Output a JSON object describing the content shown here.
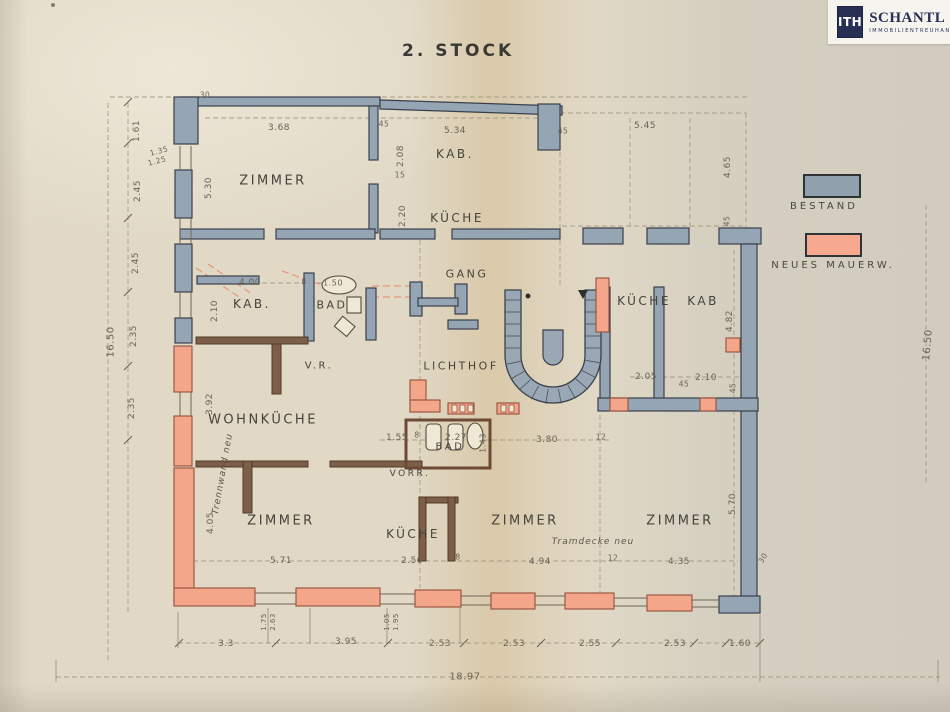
{
  "title": "2. STOCK",
  "logo": {
    "mark": "ITH",
    "name": "SCHANTL",
    "subtitle": "IMMOBILIENTREUHAND"
  },
  "legend": {
    "items": [
      {
        "label": "BESTAND",
        "color": "#91a0ad"
      },
      {
        "label": "NEUES MAUERW.",
        "color": "#f6a98e"
      }
    ]
  },
  "colors": {
    "paper": "#e1d9c6",
    "existing_wall": "#96a5b3",
    "new_wall": "#f4a68a",
    "partition": "#7d5f49",
    "ink": "#45433c"
  },
  "plan": {
    "labels": [
      {
        "text": "ZIMMER",
        "x": 273,
        "y": 181,
        "cls": "room"
      },
      {
        "text": "KAB.",
        "x": 455,
        "y": 154,
        "cls": "room",
        "size": 12
      },
      {
        "text": "KÜCHE",
        "x": 457,
        "y": 218,
        "cls": "room",
        "size": 12
      },
      {
        "text": "GANG",
        "x": 467,
        "y": 274,
        "cls": "room",
        "size": 11
      },
      {
        "text": "KAB.",
        "x": 252,
        "y": 304,
        "cls": "room",
        "size": 12
      },
      {
        "text": "BAD",
        "x": 332,
        "y": 305,
        "cls": "room",
        "size": 11
      },
      {
        "text": "KÜCHE",
        "x": 644,
        "y": 301,
        "cls": "room",
        "size": 12
      },
      {
        "text": "KAB",
        "x": 703,
        "y": 301,
        "cls": "room",
        "size": 12
      },
      {
        "text": "V.R.",
        "x": 319,
        "y": 366,
        "cls": "room",
        "size": 10
      },
      {
        "text": "LICHTHOF",
        "x": 461,
        "y": 366,
        "cls": "room",
        "size": 11
      },
      {
        "text": "WOHNKÜCHE",
        "x": 263,
        "y": 420,
        "cls": "room"
      },
      {
        "text": "BAD",
        "x": 450,
        "y": 447,
        "cls": "room",
        "size": 10
      },
      {
        "text": "VORR.",
        "x": 410,
        "y": 474,
        "cls": "room",
        "size": 9
      },
      {
        "text": "KÜCHE",
        "x": 413,
        "y": 534,
        "cls": "room",
        "size": 12
      },
      {
        "text": "ZIMMER",
        "x": 281,
        "y": 521,
        "cls": "room"
      },
      {
        "text": "ZIMMER",
        "x": 525,
        "y": 521,
        "cls": "room"
      },
      {
        "text": "ZIMMER",
        "x": 680,
        "y": 521,
        "cls": "room"
      },
      {
        "text": "Tramdecke neu",
        "x": 593,
        "y": 542,
        "cls": "note"
      },
      {
        "text": "Trennwand neu",
        "x": 223,
        "y": 474,
        "cls": "note",
        "rot": -80
      },
      {
        "text": "30",
        "x": 205,
        "y": 95,
        "cls": "dim",
        "size": 7.5
      },
      {
        "text": "3.68",
        "x": 279,
        "y": 128,
        "cls": "dim"
      },
      {
        "text": "45",
        "x": 384,
        "y": 124,
        "cls": "dim",
        "size": 7.5
      },
      {
        "text": "5.34",
        "x": 455,
        "y": 131,
        "cls": "dim"
      },
      {
        "text": "45",
        "x": 563,
        "y": 131,
        "cls": "dim",
        "size": 7.5
      },
      {
        "text": "5.45",
        "x": 645,
        "y": 126,
        "cls": "dim"
      },
      {
        "text": "1.61",
        "x": 137,
        "y": 131,
        "cls": "dim",
        "rot": -90
      },
      {
        "text": "1.35",
        "x": 159,
        "y": 151,
        "cls": "dim",
        "size": 7.5,
        "rot": -15
      },
      {
        "text": "1.25",
        "x": 157,
        "y": 161,
        "cls": "dim",
        "size": 7.5,
        "rot": -15
      },
      {
        "text": "2.45",
        "x": 138,
        "y": 191,
        "cls": "dim",
        "rot": -90
      },
      {
        "text": "2.45",
        "x": 136,
        "y": 263,
        "cls": "dim",
        "rot": -90
      },
      {
        "text": "2.35",
        "x": 134,
        "y": 336,
        "cls": "dim",
        "rot": -90
      },
      {
        "text": "2.35",
        "x": 132,
        "y": 408,
        "cls": "dim",
        "rot": -90
      },
      {
        "text": "16.50",
        "x": 111,
        "y": 342,
        "cls": "dim",
        "rot": -90,
        "size": 10
      },
      {
        "text": "4.65",
        "x": 728,
        "y": 167,
        "cls": "dim",
        "rot": -90
      },
      {
        "text": "45",
        "x": 727,
        "y": 221,
        "cls": "dim",
        "rot": -90,
        "size": 7.5
      },
      {
        "text": "4.82",
        "x": 730,
        "y": 321,
        "cls": "dim",
        "rot": -90
      },
      {
        "text": "45",
        "x": 733,
        "y": 388,
        "cls": "dim",
        "rot": -90,
        "size": 7.5
      },
      {
        "text": "5.70",
        "x": 733,
        "y": 504,
        "cls": "dim",
        "rot": -90
      },
      {
        "text": "30",
        "x": 763,
        "y": 558,
        "cls": "dim",
        "rot": -60,
        "size": 7.5
      },
      {
        "text": "16.50",
        "x": 928,
        "y": 345,
        "cls": "dim",
        "rot": -85,
        "size": 10
      },
      {
        "text": "5.30",
        "x": 209,
        "y": 188,
        "cls": "dim",
        "rot": -90
      },
      {
        "text": "2.08",
        "x": 401,
        "y": 156,
        "cls": "dim",
        "rot": -90
      },
      {
        "text": "15",
        "x": 400,
        "y": 175,
        "cls": "dim",
        "size": 7.5
      },
      {
        "text": "2.20",
        "x": 403,
        "y": 216,
        "cls": "dim",
        "rot": -90
      },
      {
        "text": "4.00",
        "x": 250,
        "y": 283,
        "cls": "dim"
      },
      {
        "text": "8",
        "x": 304,
        "y": 282,
        "cls": "dim",
        "size": 7.5
      },
      {
        "text": "1.50",
        "x": 333,
        "y": 283,
        "cls": "dim",
        "size": 8
      },
      {
        "text": "2.10",
        "x": 215,
        "y": 311,
        "cls": "dim",
        "rot": -90
      },
      {
        "text": "3.92",
        "x": 210,
        "y": 404,
        "cls": "dim",
        "rot": -90
      },
      {
        "text": "4.05",
        "x": 211,
        "y": 523,
        "cls": "dim",
        "rot": -90
      },
      {
        "text": "1.55",
        "x": 397,
        "y": 438,
        "cls": "dim"
      },
      {
        "text": "8",
        "x": 417,
        "y": 435,
        "cls": "dim",
        "size": 7.5
      },
      {
        "text": "2.27",
        "x": 456,
        "y": 438,
        "cls": "dim"
      },
      {
        "text": "1.43",
        "x": 483,
        "y": 443,
        "cls": "dim",
        "rot": -90,
        "size": 8
      },
      {
        "text": "3.80",
        "x": 547,
        "y": 440,
        "cls": "dim"
      },
      {
        "text": "12",
        "x": 601,
        "y": 437,
        "cls": "dim",
        "size": 7.5
      },
      {
        "text": "2.05",
        "x": 646,
        "y": 377,
        "cls": "dim"
      },
      {
        "text": "45",
        "x": 684,
        "y": 384,
        "cls": "dim",
        "size": 7.5
      },
      {
        "text": "2.10",
        "x": 706,
        "y": 378,
        "cls": "dim"
      },
      {
        "text": "2.56",
        "x": 412,
        "y": 561,
        "cls": "dim"
      },
      {
        "text": "8",
        "x": 458,
        "y": 557,
        "cls": "dim",
        "size": 7.5
      },
      {
        "text": "4.94",
        "x": 540,
        "y": 562,
        "cls": "dim"
      },
      {
        "text": "12",
        "x": 613,
        "y": 558,
        "cls": "dim",
        "size": 7.5
      },
      {
        "text": "4.35",
        "x": 679,
        "y": 562,
        "cls": "dim"
      },
      {
        "text": "5.71",
        "x": 281,
        "y": 561,
        "cls": "dim"
      },
      {
        "text": "3.3",
        "x": 226,
        "y": 644,
        "cls": "dim"
      },
      {
        "text": "3.95",
        "x": 346,
        "y": 642,
        "cls": "dim"
      },
      {
        "text": "2.53",
        "x": 440,
        "y": 644,
        "cls": "dim"
      },
      {
        "text": "2.53",
        "x": 514,
        "y": 644,
        "cls": "dim"
      },
      {
        "text": "2.55",
        "x": 590,
        "y": 644,
        "cls": "dim"
      },
      {
        "text": "2.53",
        "x": 675,
        "y": 644,
        "cls": "dim"
      },
      {
        "text": "1.60",
        "x": 740,
        "y": 644,
        "cls": "dim"
      },
      {
        "text": "18.97",
        "x": 465,
        "y": 677,
        "cls": "dim",
        "size": 10
      },
      {
        "text": "1.75",
        "x": 264,
        "y": 622,
        "cls": "dim",
        "rot": -90,
        "size": 7
      },
      {
        "text": "2.63",
        "x": 273,
        "y": 622,
        "cls": "dim",
        "rot": -90,
        "size": 7
      },
      {
        "text": "1.05",
        "x": 387,
        "y": 622,
        "cls": "dim",
        "rot": -90,
        "size": 7
      },
      {
        "text": "1.95",
        "x": 396,
        "y": 622,
        "cls": "dim",
        "rot": -90,
        "size": 7
      }
    ]
  }
}
